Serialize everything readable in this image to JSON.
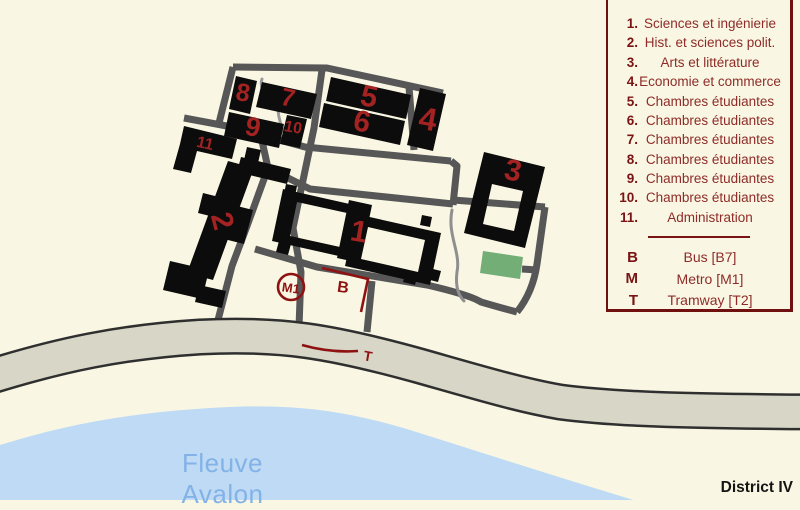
{
  "map": {
    "building_labels": [
      {
        "id": "1",
        "text": "1"
      },
      {
        "id": "2",
        "text": "2"
      },
      {
        "id": "3",
        "text": "3"
      },
      {
        "id": "4",
        "text": "4"
      },
      {
        "id": "5",
        "text": "5"
      },
      {
        "id": "6",
        "text": "6"
      },
      {
        "id": "7",
        "text": "7"
      },
      {
        "id": "8",
        "text": "8"
      },
      {
        "id": "9",
        "text": "9"
      },
      {
        "id": "10",
        "text": "10"
      },
      {
        "id": "11",
        "text": "11"
      }
    ],
    "markers": {
      "metro": "M1",
      "bus": "B",
      "tram": "T"
    },
    "river_name": "Fleuve Avalon",
    "district_label": "District IV"
  },
  "legend": {
    "items": [
      {
        "num": "1.",
        "label": "Sciences et ingénierie"
      },
      {
        "num": "2.",
        "label": "Hist. et sciences polit."
      },
      {
        "num": "3.",
        "label": "Arts et littérature"
      },
      {
        "num": "4.",
        "label": "Economie et commerce"
      },
      {
        "num": "5.",
        "label": "Chambres étudiantes"
      },
      {
        "num": "6.",
        "label": "Chambres étudiantes"
      },
      {
        "num": "7.",
        "label": "Chambres étudiantes"
      },
      {
        "num": "8.",
        "label": "Chambres étudiantes"
      },
      {
        "num": "9.",
        "label": "Chambres étudiantes"
      },
      {
        "num": "10.",
        "label": "Chambres étudiantes"
      },
      {
        "num": "11.",
        "label": "Administration"
      }
    ],
    "transit": [
      {
        "key": "B",
        "label": "Bus [B7]"
      },
      {
        "key": "M",
        "label": "Metro [M1]"
      },
      {
        "key": "T",
        "label": "Tramway [T2]"
      }
    ]
  },
  "colors": {
    "background": "#f9f7e3",
    "building": "#0c0c0c",
    "road": "#575757",
    "main_road_fill": "#d8d7c7",
    "main_road_edge": "#2f2f2f",
    "river": "#bedaf4",
    "river_text": "#83b2e7",
    "field_green": "#73ae76",
    "numeral_red": "#a32222",
    "marker_red": "#8f1212",
    "legend_border": "#70100f",
    "legend_number": "#7a1314",
    "legend_text": "#8e2b28"
  }
}
